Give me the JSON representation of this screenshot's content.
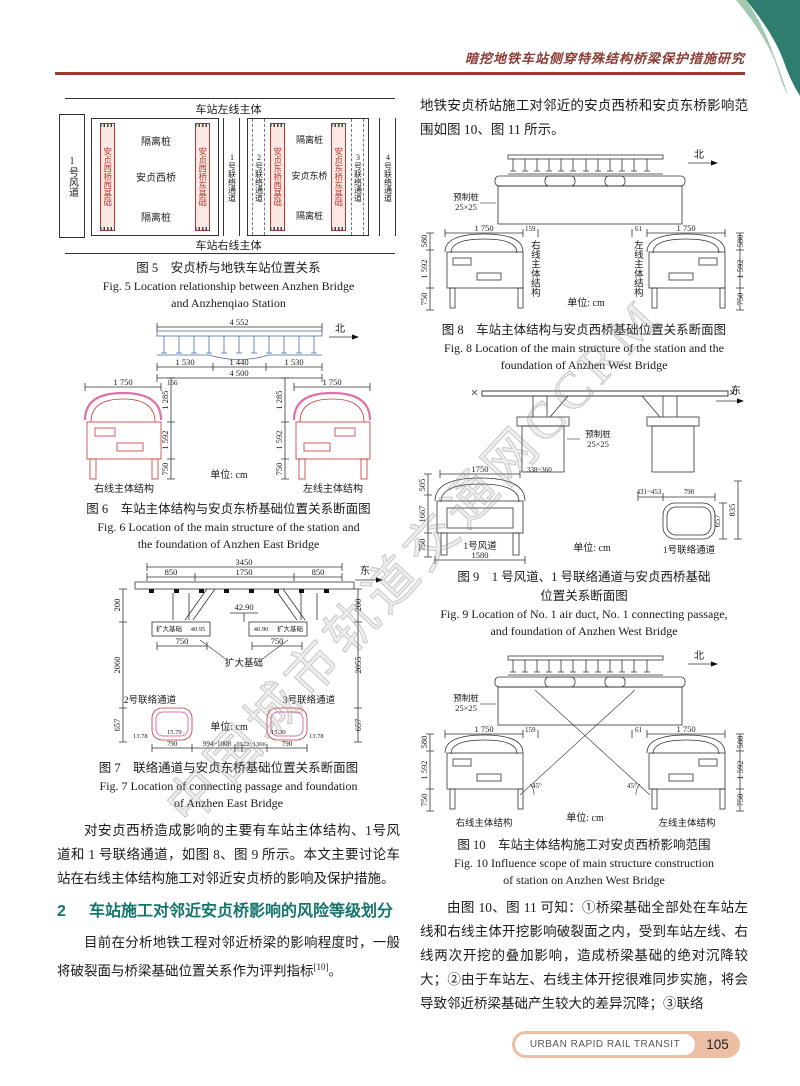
{
  "page": {
    "header_title": "暗挖地铁车站侧穿特殊结构桥梁保护措施研究",
    "watermark": "中国城市轨道交通网CCRM",
    "unit_label": "单位: cm",
    "footer": {
      "journal": "URBAN RAPID RAIL TRANSIT",
      "page_number": "105"
    }
  },
  "left": {
    "fig5": {
      "station_left": "车站左线主体",
      "station_right": "车站右线主体",
      "wind_duct": "1号风道",
      "isolation": "隔离桩",
      "west_bridge": "安贞西桥",
      "east_bridge": "安贞东桥",
      "ww_found": "安贞西桥西基础",
      "we_found": "安贞西桥东基础",
      "ew_found": "安贞东桥西基础",
      "ee_found": "安贞东桥东基础",
      "passage1": "1号联络通道",
      "passage2": "2号联络通道",
      "passage3": "3号联络通道",
      "passage4": "4号联络通道",
      "cap_zh": "图 5　安贞桥与地铁车站位置关系",
      "cap_en1": "Fig. 5   Location relationship between Anzhen Bridge",
      "cap_en2": "and Anzhenqiao Station"
    },
    "fig6": {
      "d4552": "4 552",
      "north": "北",
      "d1530": "1 530",
      "d1440": "1 440",
      "d4500": "4 500",
      "d1750": "1 750",
      "d156": "156",
      "d1285": "1 285",
      "d1592": "1 592",
      "d750": "750",
      "right_line": "右线主体结构",
      "left_line": "左线主体结构",
      "cap_zh": "图 6　车站主体结构与安贞东桥基础位置关系断面图",
      "cap_en1": "Fig. 6   Location of the main structure of the station and",
      "cap_en2": "the foundation of Anzhen East Bridge"
    },
    "fig7": {
      "d3450": "3450",
      "d850": "850",
      "d1750": "1750",
      "east": "东",
      "elev": "42.90",
      "found": "扩大基础",
      "e4095": "40.95",
      "e4090": "40.90",
      "d750": "750",
      "d200": "200",
      "d2060": "2060",
      "d2055": "2055",
      "d657": "657",
      "passage2": "2号联络通道",
      "passage3": "3号联络通道",
      "n1378": "13.78",
      "n1579": "15.79",
      "n1530": "15.30",
      "d790": "790",
      "d994": "994~1008",
      "d1322": "1322~1366",
      "cap_zh": "图 7　联络通道与安贞东桥基础位置关系断面图",
      "cap_en1": "Fig. 7   Location of connecting passage and foundation",
      "cap_en2": "of Anzhen East Bridge"
    },
    "para1": "对安贞西桥造成影响的主要有车站主体结构、1号风道和 1 号联络通道，如图 8、图 9 所示。本文主要讨论车站在右线主体结构施工对邻近安贞桥的影响及保护措施。",
    "section2": {
      "num": "2",
      "title": "车站施工对邻近安贞桥影响的风险等级划分"
    },
    "para2_main": "目前在分析地铁工程对邻近桥梁的影响程度时，一般将破裂面与桥梁基础位置关系作为评判指标",
    "para2_sup": "[10]",
    "para2_end": "。"
  },
  "right": {
    "para1": "地铁安贞桥站施工对邻近的安贞西桥和安贞东桥影响范围如图 10、图 11 所示。",
    "fig8": {
      "north": "北",
      "precast1": "预制桩",
      "precast2": "25×25",
      "d580": "580",
      "d1592": "1 592",
      "d750": "750",
      "d1750": "1 750",
      "d159": "159",
      "d61": "61",
      "right_line": "右线主体结构",
      "left_line": "左线主体结构",
      "cap_zh": "图 8　车站主体结构与安贞西桥基础位置关系断面图",
      "cap_en1": "Fig. 8   Location of the main structure of the station and the",
      "cap_en2": "foundation of Anzhen West Bridge"
    },
    "fig9": {
      "east": "东",
      "precast1": "预制桩",
      "precast2": "25×25",
      "d505": "505",
      "d1750": "1750",
      "d338": "338~360",
      "d1667": "1667",
      "d750": "750",
      "duct": "1号风道",
      "d1580": "1580",
      "d431": "431~453",
      "d790": "790",
      "d835": "835",
      "d657": "657",
      "passage": "1号联络通道",
      "cap_zh1": "图 9　1 号风道、1 号联络通道与安贞西桥基础",
      "cap_zh2": "位置关系断面图",
      "cap_en1": "Fig. 9   Location of No. 1 air duct, No. 1 connecting passage,",
      "cap_en2": "and foundation of Anzhen West Bridge"
    },
    "fig10": {
      "north": "北",
      "precast1": "预制桩",
      "precast2": "25×25",
      "d580": "580",
      "d1592": "1 592",
      "d750": "750",
      "d1750": "1 750",
      "d159": "159",
      "d61": "61",
      "a45": "45°",
      "right_line": "右线主体结构",
      "left_line": "左线主体结构",
      "cap_zh": "图 10　车站主体结构施工对安贞西桥影响范围",
      "cap_en1": "Fig. 10   Influence scope of main structure construction",
      "cap_en2": "of station on Anzhen West Bridge"
    },
    "para2": "由图 10、图 11 可知：①桥梁基础全部处在车站左线和右线主体开挖影响破裂面之内，受到车站左线、右线两次开挖的叠加影响，造成桥梁基础的绝对沉降较大；②由于车站左、右线主体开挖很难同步实施，将会导致邻近桥梁基础产生较大的差异沉降；③联络"
  }
}
